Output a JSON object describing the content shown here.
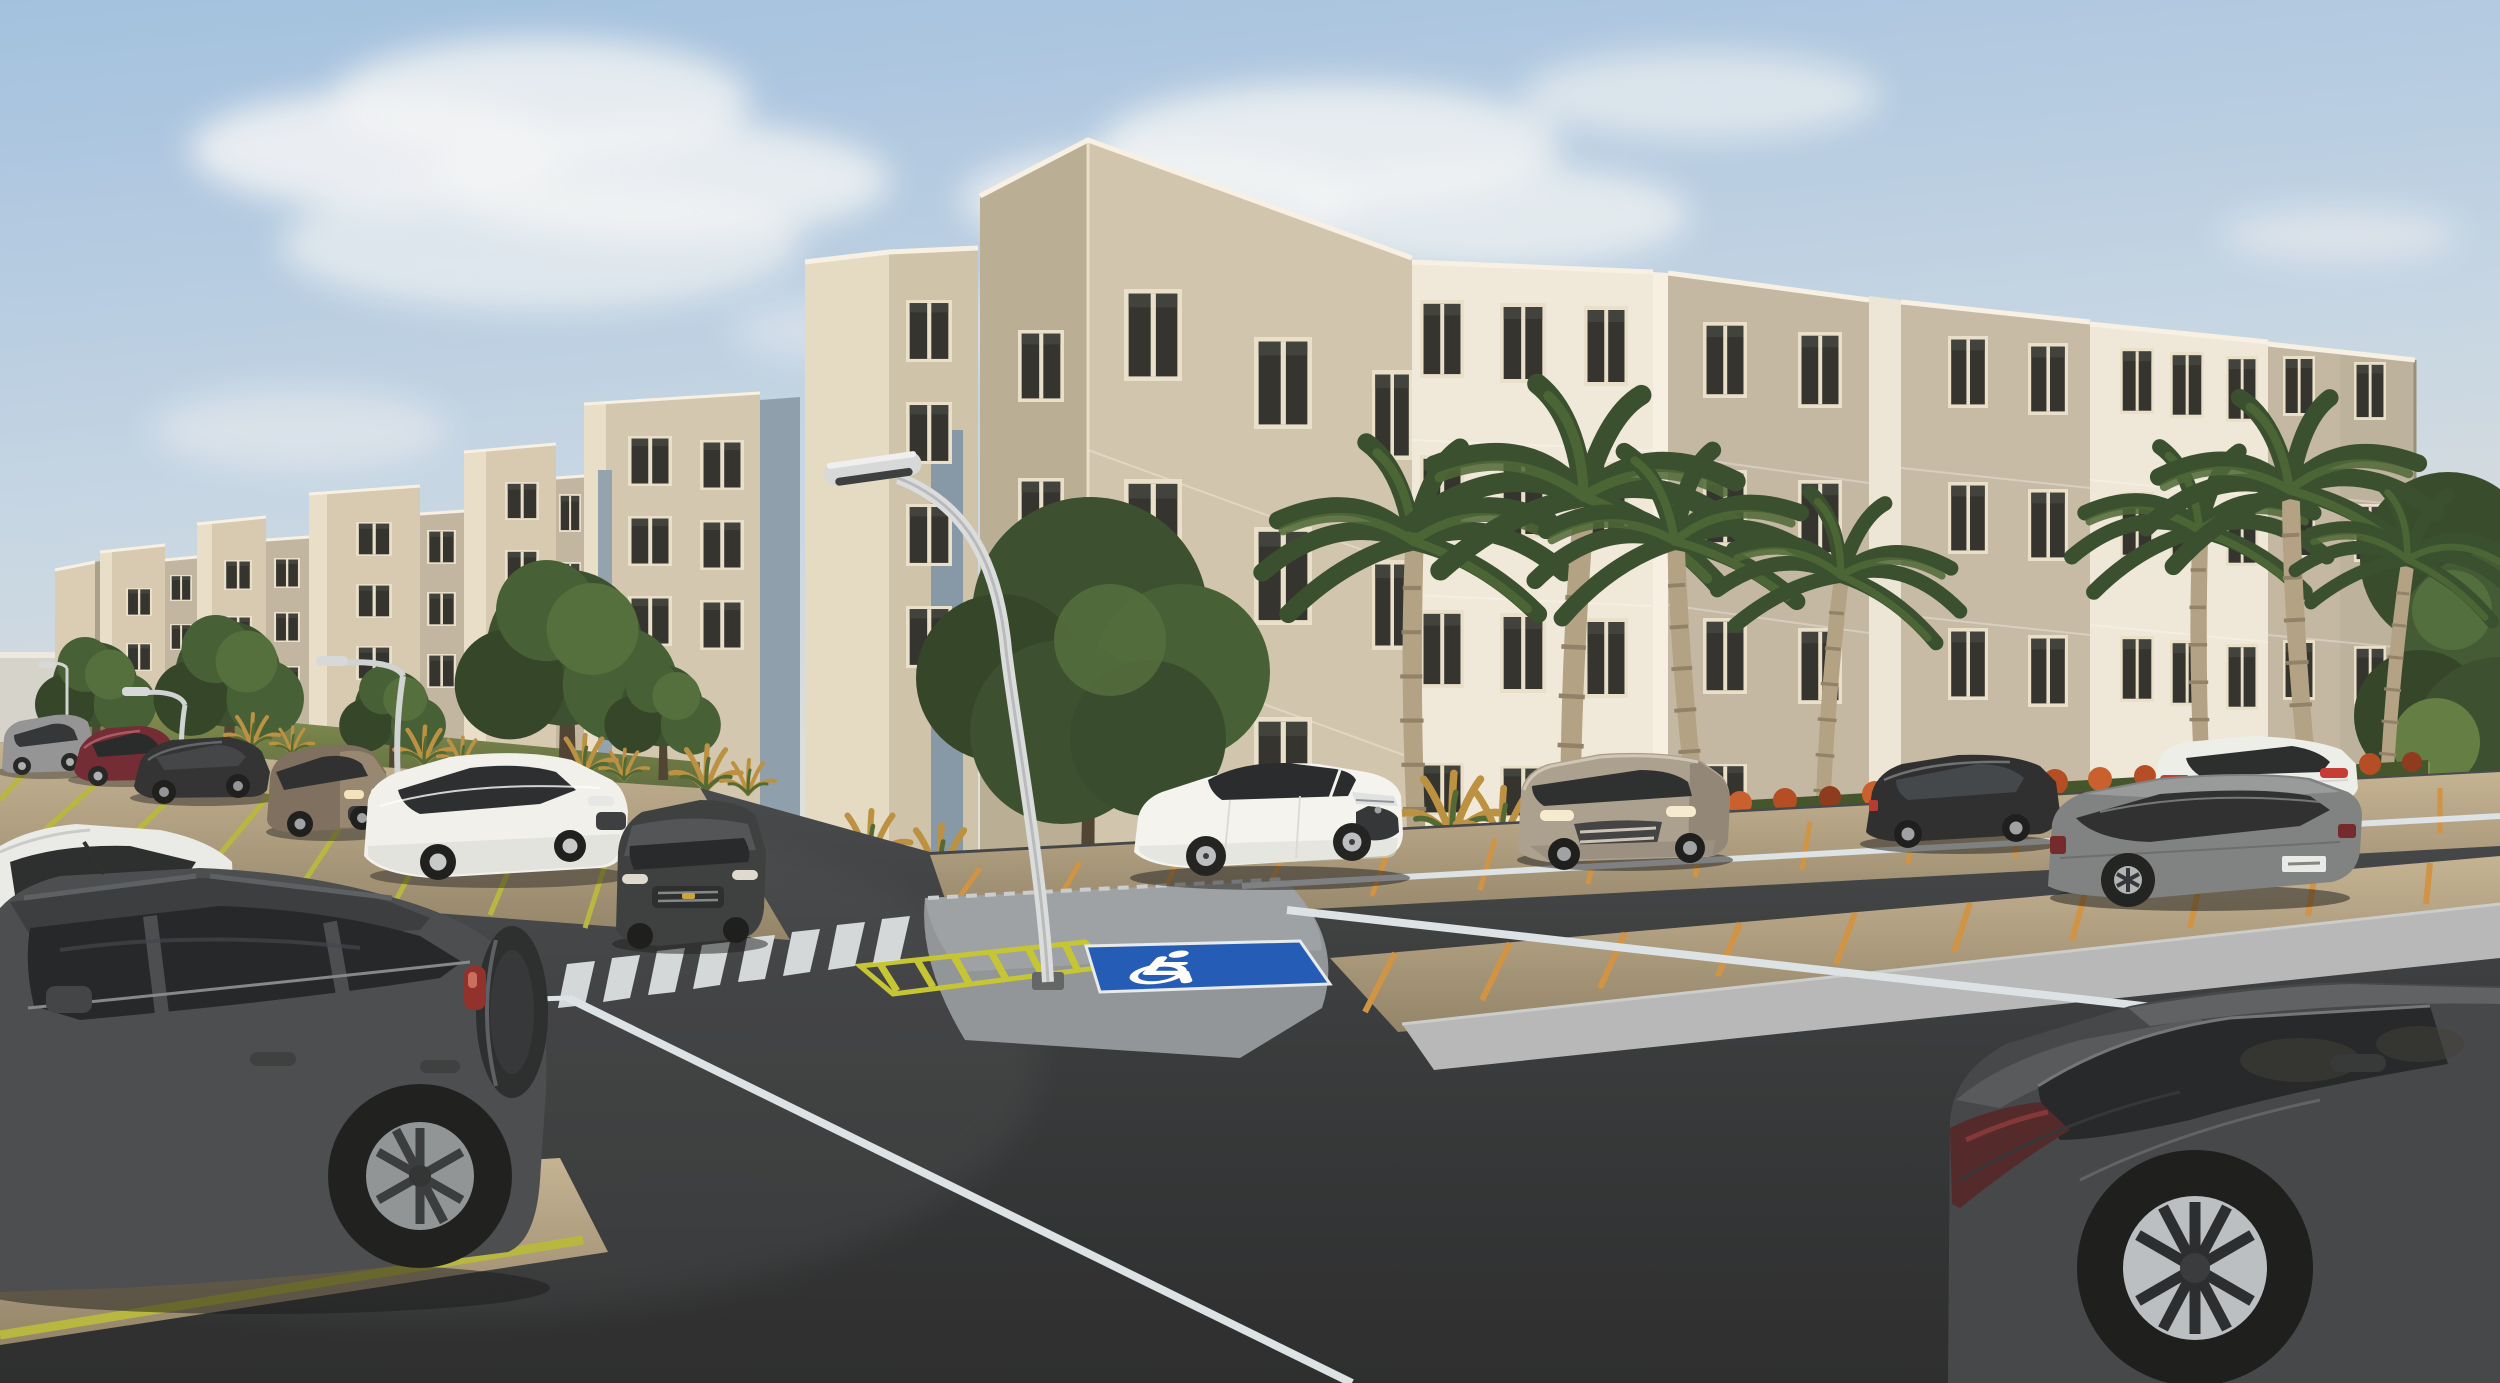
{
  "meta": {
    "type": "3d-architectural-rendering",
    "scene": "apartment-complex-with-parking-lot",
    "lighting": "warm-late-afternoon-sun-from-left"
  },
  "palette": {
    "sky_top": "#9fc0e2",
    "sky_horizon": "#e2e3dd",
    "cloud": "#f3f6f9",
    "tower_cream": "#d5cab3",
    "tower_side_light": "#e8dfca",
    "facade_beige": "#c1b7a3",
    "facade_white": "#f0eadd",
    "facade_shadow": "#b7ac95",
    "slot_blue_gray": "#8398ab",
    "window_frame": "#e9e1cd",
    "window_glass": "#2b2c29",
    "grass": "#6d7c42",
    "tree_green": "#3a5530",
    "palm_green": "#30492a",
    "palm_trunk": "#b0a083",
    "hedge_orange": "#b2471f",
    "cycad_gold": "#b98f3e",
    "gravel": "#b2a184",
    "line_yellow": "#b5b73b",
    "line_orange": "#cf9040",
    "island_paver": "#8e9399",
    "hatch_yellow": "#c3c52f",
    "handicap_blue": "#1a57b8",
    "asphalt": "#33373b",
    "road_line_white": "#dce3e8",
    "crosswalk_white": "#dee4e8"
  },
  "buildings": {
    "floors": 4,
    "modules": 11,
    "style": "stepped stair-towers alternating with recessed window facades",
    "window_type": "two-pane sliding, cream frames, dark glass"
  },
  "vehicles": [
    {
      "id": "car-1",
      "label": "silver compact SUV, far left back row",
      "color": "#8f9294"
    },
    {
      "id": "car-2",
      "label": "burgundy sedan, back row",
      "color": "#6d2330"
    },
    {
      "id": "car-3",
      "label": "black sedan, back row",
      "color": "#2a2c2f"
    },
    {
      "id": "car-4",
      "label": "brown compact SUV, back row",
      "color": "#796b5c"
    },
    {
      "id": "car-5",
      "label": "white sedan, back row left-center",
      "color": "#f1f2f0"
    },
    {
      "id": "car-6",
      "label": "dark gray sedan facing viewer, center-left",
      "color": "#35393d"
    },
    {
      "id": "car-7",
      "label": "white Corolla-style sedan, center",
      "color": "#f4f5f3"
    },
    {
      "id": "car-8",
      "label": "champagne compact SUV, center-right",
      "color": "#a89e8f"
    },
    {
      "id": "car-9",
      "label": "black sedan, right back row",
      "color": "#26282b"
    },
    {
      "id": "car-10",
      "label": "white sedan rear view, far right back row",
      "color": "#eef0ee"
    },
    {
      "id": "car-11",
      "label": "gray large sedan rear three-quarter, right",
      "color": "#7b7e81"
    },
    {
      "id": "car-12",
      "label": "white vehicle partially cropped, left edge",
      "color": "#e9ebea"
    },
    {
      "id": "car-13",
      "label": "dark SUV with rear spare wheel, foreground",
      "color": "#43474c"
    },
    {
      "id": "car-14",
      "label": "dark sedan rear three-quarter, foreground right",
      "color": "#3e4145"
    }
  ],
  "landscape": {
    "royal_palms": 7,
    "round_trees": 6,
    "hedge": "orange flowering shrubs along right building base",
    "accents": "golden cycad palms along left building base",
    "grass_strips": true
  },
  "street_furniture": {
    "curved_street_lamps": 4,
    "lamp_color": "#d5d9dc"
  },
  "road_markings": {
    "crosswalk_stripes": 8,
    "handicap_stall": "blue square with white wheelchair symbol",
    "no_parking_hatch": "yellow diagonal hatching",
    "parking_dividers_left": "yellow-green",
    "parking_dividers_right": "orange",
    "road_edge_lines": "white"
  }
}
